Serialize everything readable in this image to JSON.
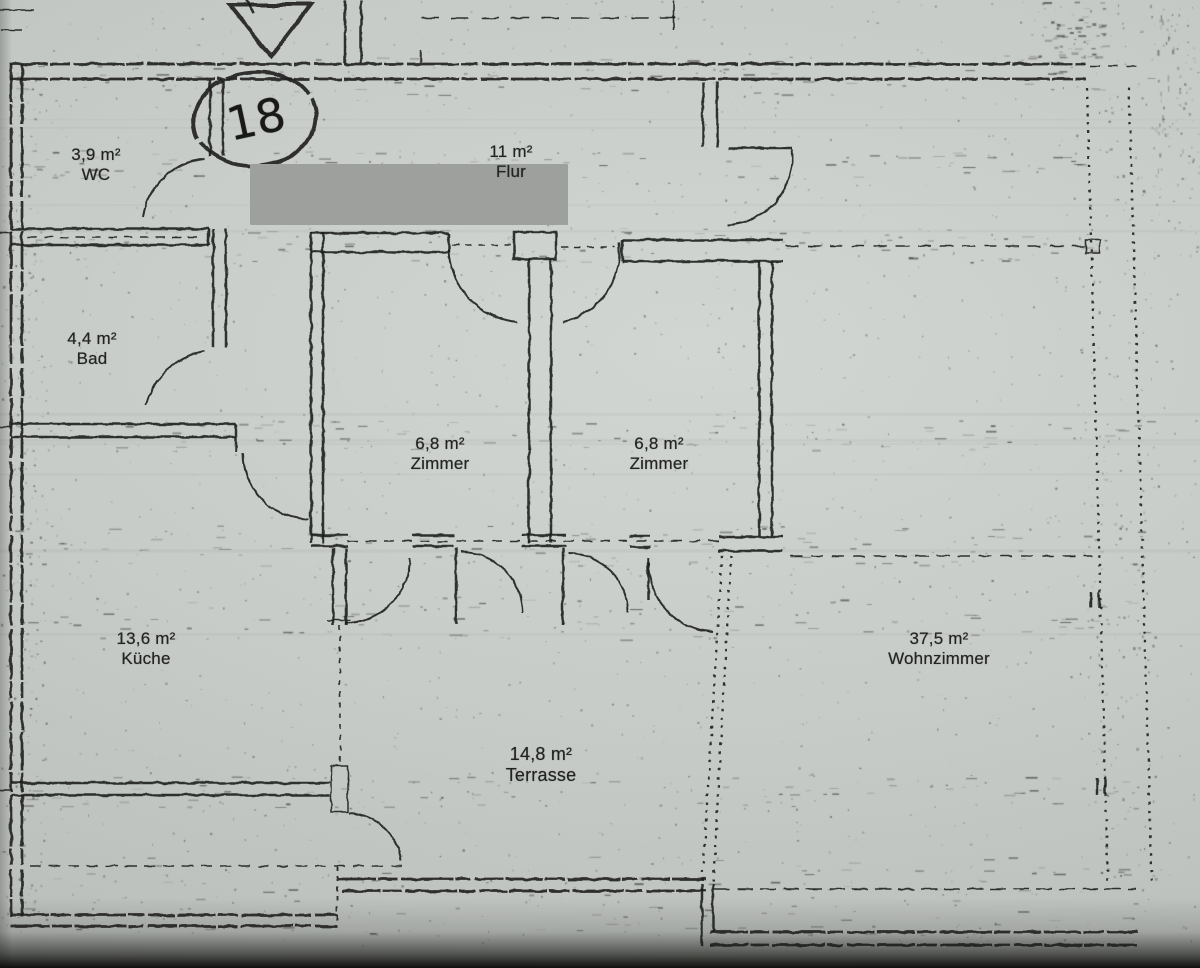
{
  "plan": {
    "kind": "floor-plan-scan",
    "rooms": [
      {
        "id": "wc",
        "area": "3,9 m²",
        "name": "WC"
      },
      {
        "id": "flur",
        "area": "11 m²",
        "name": "Flur"
      },
      {
        "id": "bad",
        "area": "4,4 m²",
        "name": "Bad"
      },
      {
        "id": "zimmer-1",
        "area": "6,8 m²",
        "name": "Zimmer"
      },
      {
        "id": "zimmer-2",
        "area": "6,8 m²",
        "name": "Zimmer"
      },
      {
        "id": "kueche",
        "area": "13,6 m²",
        "name": "Küche"
      },
      {
        "id": "wohnzimmer",
        "area": "37,5 m²",
        "name": "Wohnzimmer"
      },
      {
        "id": "terrasse",
        "area": "14,8 m²",
        "name": "Terrasse"
      }
    ],
    "annotation": {
      "unit_number": "18"
    },
    "symbols": {
      "entrance_arrow": "triangle-down-icon",
      "unit_circle": "hand-drawn-ellipse",
      "windows_right": "dotted-double-line",
      "doors": "quarter-arc-swing"
    },
    "colors": {
      "paper": "#c7cbc7",
      "ink": "#1e1f1d",
      "redaction": "#9da09d"
    }
  }
}
